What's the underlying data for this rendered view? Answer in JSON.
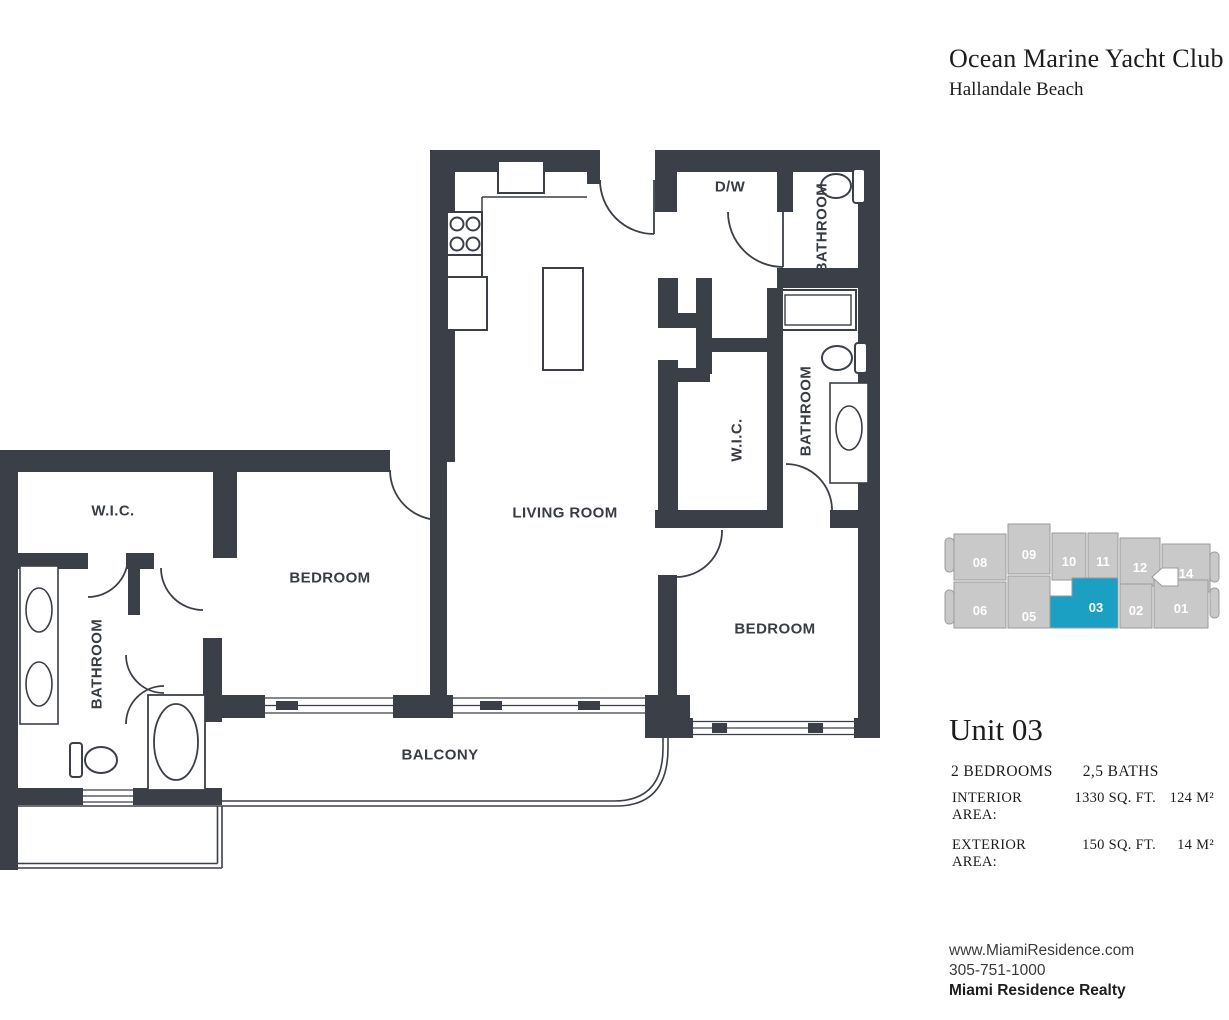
{
  "header": {
    "title": "Ocean Marine Yacht Club",
    "subtitle": "Hallandale Beach"
  },
  "floor_plan": {
    "labels": {
      "dw": "D/W",
      "bathroom_top_right": "BATHROOM",
      "wic_right": "W.I.C.",
      "bathroom_right": "BATHROOM",
      "living_room": "LIVING ROOM",
      "bedroom_right": "BEDROOM",
      "bedroom_left": "BEDROOM",
      "wic_left": "W.I.C.",
      "bathroom_left": "BATHROOM",
      "balcony": "BALCONY"
    },
    "wall_color": "#3b3f47"
  },
  "key_plan": {
    "highlighted_unit": "03",
    "highlight_color": "#1ba0c3",
    "unit_color": "#c9c9c9",
    "units": [
      {
        "label": "08"
      },
      {
        "label": "09"
      },
      {
        "label": "10"
      },
      {
        "label": "11"
      },
      {
        "label": "12"
      },
      {
        "label": "14"
      },
      {
        "label": "06"
      },
      {
        "label": "05"
      },
      {
        "label": "03"
      },
      {
        "label": "02"
      },
      {
        "label": "01"
      }
    ]
  },
  "unit_info": {
    "name": "Unit 03",
    "bedrooms": "2 BEDROOMS",
    "baths": "2,5 BATHS",
    "rows": [
      {
        "label": "INTERIOR AREA:",
        "sqft": "1330 SQ. FT.",
        "m2": "124 M²"
      },
      {
        "label": "EXTERIOR AREA:",
        "sqft": "150 SQ. FT.",
        "m2": "14 M²"
      }
    ]
  },
  "footer": {
    "website": "www.MiamiResidence.com",
    "phone": "305-751-1000",
    "company": "Miami Residence Realty"
  }
}
